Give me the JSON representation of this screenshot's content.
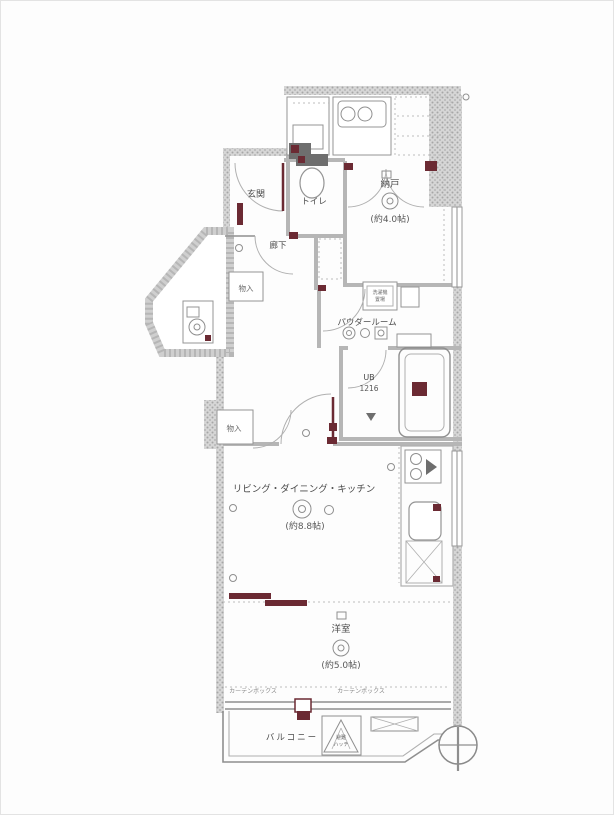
{
  "plan": {
    "entrance": "玄関",
    "toilet": "トイレ",
    "storage_room": "納戸",
    "storage_room_size": "(約4.0帖)",
    "hallway": "廊下",
    "closet_upper": "物入",
    "closet_lower": "物入",
    "powder_room": "パウダールーム",
    "laundry_l1": "洗濯機",
    "laundry_l2": "置場",
    "bath_l1": "UB",
    "bath_l2": "1216",
    "ldk": "リビング・ダイニング・キッチン",
    "ldk_size": "(約8.8帖)",
    "bedroom": "洋室",
    "bedroom_size": "(約5.0帖)",
    "curtain_left": "カーテンボックス",
    "curtain_right": "カーテンボックス",
    "balcony": "バルコニー",
    "hatch_l1": "避難",
    "hatch_l2": "ハッチ"
  },
  "colors": {
    "wall": "#c9c9c9",
    "line": "#8a8a8a",
    "accent": "#6b2a33",
    "background": "#fdfdfd"
  }
}
